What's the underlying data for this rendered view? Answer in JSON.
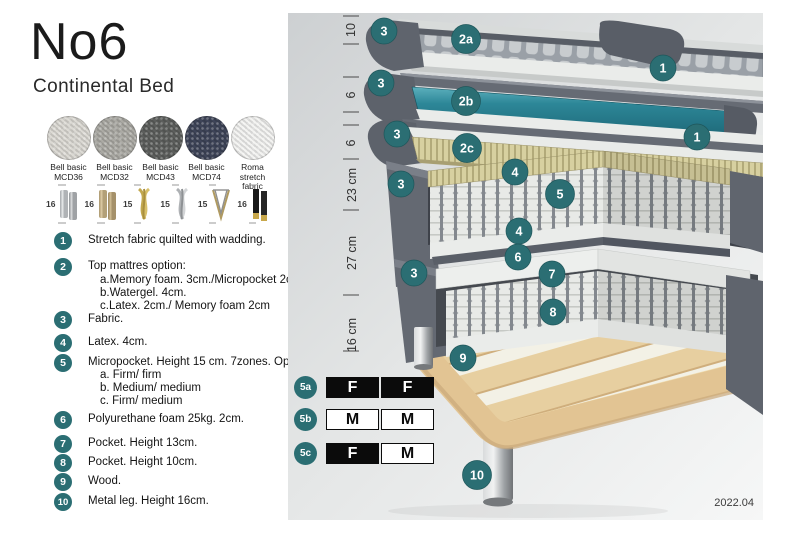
{
  "header": {
    "title": "No6",
    "subtitle": "Continental Bed"
  },
  "swatches": [
    {
      "line1": "Bell basic",
      "line2": "MCD36",
      "color": "#dcdad4"
    },
    {
      "line1": "Bell basic",
      "line2": "MCD32",
      "color": "#abaaa4"
    },
    {
      "line1": "Bell basic",
      "line2": "MCD43",
      "color": "#5c5e5c"
    },
    {
      "line1": "Bell basic",
      "line2": "MCD74",
      "color": "#3e4458"
    },
    {
      "line1": "Roma",
      "line2": "stretch fabric",
      "color": "#f3f3f1"
    }
  ],
  "leg_options": [
    {
      "height": "16",
      "type": "chrome-cylinder"
    },
    {
      "height": "16",
      "type": "wood-cylinder"
    },
    {
      "height": "15",
      "type": "gold-twist"
    },
    {
      "height": "15",
      "type": "silver-twist"
    },
    {
      "height": "15",
      "type": "hairpin"
    },
    {
      "height": "16",
      "type": "black-gold"
    }
  ],
  "legend": [
    {
      "num": "1",
      "text": "Stretch fabric quilted with wadding."
    },
    {
      "num": "2",
      "text": "Top mattres option:",
      "sub": [
        "a.Memory foam. 3cm./Micropocket 2cm",
        "b.Watergel. 4cm.",
        "c.Latex. 2cm./ Memory foam 2cm"
      ]
    },
    {
      "num": "3",
      "text": "Fabric."
    },
    {
      "num": "4",
      "text": "Latex. 4cm."
    },
    {
      "num": "5",
      "text": "Micropocket. Height 15 cm. 7zones. Option:",
      "sub": [
        "a. Firm/ firm",
        "b. Medium/ medium",
        "c. Firm/ medium"
      ]
    },
    {
      "num": "6",
      "text": "Polyurethane foam 25kg. 2cm."
    },
    {
      "num": "7",
      "text": "Pocket. Height 13cm."
    },
    {
      "num": "8",
      "text": "Pocket. Height 10cm."
    },
    {
      "num": "9",
      "text": "Wood."
    },
    {
      "num": "10",
      "text": "Metal leg. Height 16cm."
    }
  ],
  "diagram": {
    "measurements": [
      "10",
      "6",
      "6",
      "23 cm",
      "27 cm",
      "16 cm"
    ],
    "callouts": [
      "3",
      "2a",
      "1",
      "3",
      "2b",
      "1",
      "3",
      "2c",
      "3",
      "4",
      "5",
      "4",
      "6",
      "7",
      "8",
      "3",
      "9",
      "10"
    ],
    "firmness": [
      {
        "id": "5a",
        "cells": [
          {
            "label": "F",
            "style": "dark"
          },
          {
            "label": "F",
            "style": "dark"
          }
        ]
      },
      {
        "id": "5b",
        "cells": [
          {
            "label": "M",
            "style": "light"
          },
          {
            "label": "M",
            "style": "light"
          }
        ]
      },
      {
        "id": "5c",
        "cells": [
          {
            "label": "F",
            "style": "dark"
          },
          {
            "label": "M",
            "style": "light"
          }
        ]
      }
    ],
    "version": "2022.04",
    "accent_color": "#2b6e73",
    "watergel_color": "#2d8798"
  }
}
